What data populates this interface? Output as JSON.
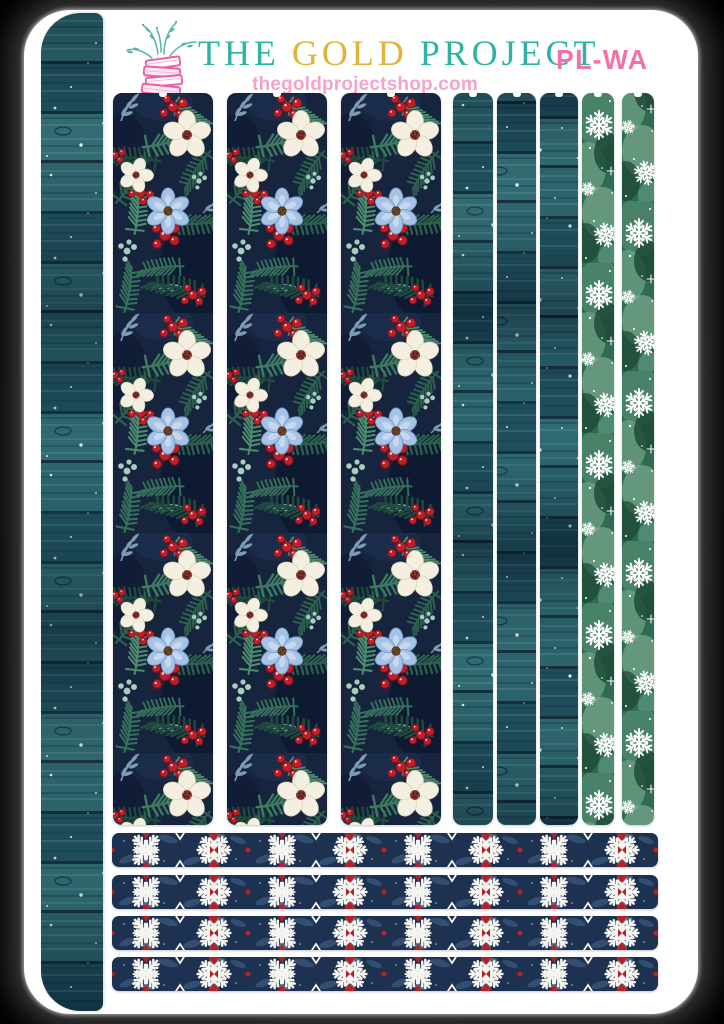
{
  "window": {
    "type": "product-image",
    "width": 724,
    "height": 1024,
    "background": "black with soft grey glow around white sheet"
  },
  "header": {
    "logo_icon": "stack-of-pink-books-with-teal-ferns",
    "title_parts": [
      {
        "text": "THE",
        "color": "#2eb2a4"
      },
      {
        "text": "GOLD",
        "color": "#e2b23a"
      },
      {
        "text": "PROJECT",
        "color": "#2eb2a4"
      }
    ],
    "website": "thegoldprojectshop.com",
    "website_color": "#f5a3ca",
    "product_code": "PL-WA",
    "product_code_color": "#f470ad"
  },
  "sheet": {
    "kind": "planner washi sticker sheet, white rounded card",
    "vertical_strips": [
      {
        "name": "left-full-height-strip",
        "pattern": "dark-teal-wood-planks-with-snow",
        "count": 1
      },
      {
        "name": "wide-floral-strip",
        "pattern": "navy-winter-floral: white flowers, blue flowers, red berries, pine",
        "count": 3
      },
      {
        "name": "narrow-wood-strip",
        "pattern": "dark-teal-wood-planks-with-snow",
        "count": 3
      },
      {
        "name": "narrow-snowflake-strip",
        "pattern": "green-watercolor-with-white-snowflakes",
        "count": 2
      }
    ],
    "horizontal_strips": [
      {
        "name": "nordic-washi-strip",
        "pattern": "navy-nordic-snowflake-medallions-with-red-accents",
        "count": 4
      }
    ],
    "palette": {
      "navy_floral_bg": "#16243e",
      "cream_flower": "#f4efe0",
      "flower_center_red": "#7a302c",
      "blue_flower": "#a6c2e4",
      "berry_red": "#c01f2a",
      "pine_green": "#2c5f4c",
      "mint": "#a6cdbd",
      "wood_teal": "#265a63",
      "snow_strip_green": "#2e6b52",
      "washi_navy": "#1d3150",
      "washi_red": "#b22028"
    }
  }
}
